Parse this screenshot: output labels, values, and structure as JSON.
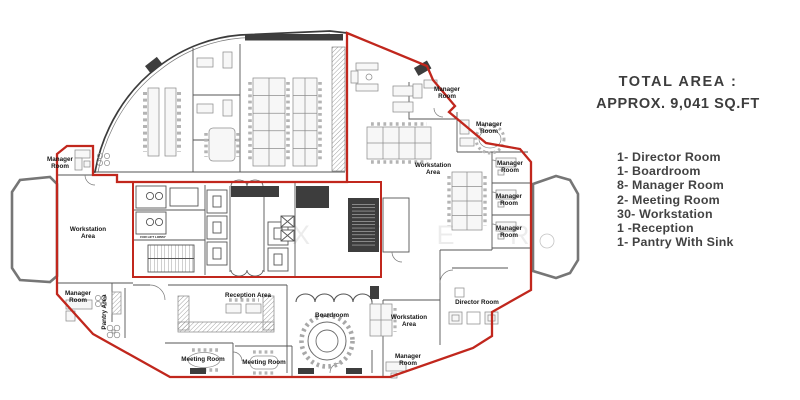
{
  "panel": {
    "title_line1": "TOTAL AREA :",
    "title_line2": "APPROX. 9,041 SQ.FT",
    "items": [
      "1- Director Room",
      "1- Boardroom",
      "8- Manager Room",
      "2- Meeting Room",
      "30- Workstation",
      "1 -Reception",
      "1- Pantry With Sink"
    ]
  },
  "plan": {
    "watermark": "X T E R I O",
    "colors": {
      "boundary_red": "#c1271d",
      "wall": "#4e4e4e"
    },
    "rooms": [
      {
        "id": "label-manager-room-top-left",
        "lines": [
          "Manager",
          "Room"
        ],
        "x": 60,
        "y": 161
      },
      {
        "id": "label-workstation-area-left",
        "lines": [
          "Workstation",
          "Area"
        ],
        "x": 88,
        "y": 231
      },
      {
        "id": "label-manager-room-bottom-left",
        "lines": [
          "Manager",
          "Room"
        ],
        "x": 78,
        "y": 295
      },
      {
        "id": "label-pantry-area",
        "lines": [
          "Pantry Area"
        ],
        "x": 106,
        "y": 312,
        "rotate": -90
      },
      {
        "id": "label-reception-area",
        "lines": [
          "Reception Area"
        ],
        "x": 248,
        "y": 297
      },
      {
        "id": "label-meeting-room-1",
        "lines": [
          "Meeting Room"
        ],
        "x": 203,
        "y": 361
      },
      {
        "id": "label-meeting-room-2",
        "lines": [
          "Meeting Room"
        ],
        "x": 264,
        "y": 364
      },
      {
        "id": "label-boardroom",
        "lines": [
          "Boardroom"
        ],
        "x": 332,
        "y": 317
      },
      {
        "id": "label-workstation-area-bottom",
        "lines": [
          "Workstation",
          "Area"
        ],
        "x": 409,
        "y": 319
      },
      {
        "id": "label-manager-room-bottom-right",
        "lines": [
          "Manager",
          "Room"
        ],
        "x": 408,
        "y": 358
      },
      {
        "id": "label-director-room",
        "lines": [
          "Director Room"
        ],
        "x": 477,
        "y": 304
      },
      {
        "id": "label-manager-room-top-1",
        "lines": [
          "Manager",
          "Room"
        ],
        "x": 447,
        "y": 91
      },
      {
        "id": "label-manager-room-top-2",
        "lines": [
          "Manager",
          "Room"
        ],
        "x": 489,
        "y": 126
      },
      {
        "id": "label-workstation-area-top",
        "lines": [
          "Workstation",
          "Area"
        ],
        "x": 433,
        "y": 167
      },
      {
        "id": "label-manager-room-right-1",
        "lines": [
          "Manager",
          "Room"
        ],
        "x": 510,
        "y": 165
      },
      {
        "id": "label-manager-room-right-2",
        "lines": [
          "Manager",
          "Room"
        ],
        "x": 509,
        "y": 198
      },
      {
        "id": "label-manager-room-right-3",
        "lines": [
          "Manager",
          "Room"
        ],
        "x": 509,
        "y": 230
      }
    ],
    "small_labels": [
      {
        "id": "label-lift-lobby",
        "lines": [
          "FOR LIFT LOBBY"
        ],
        "x": 153,
        "y": 238,
        "size": 3.1
      }
    ]
  }
}
